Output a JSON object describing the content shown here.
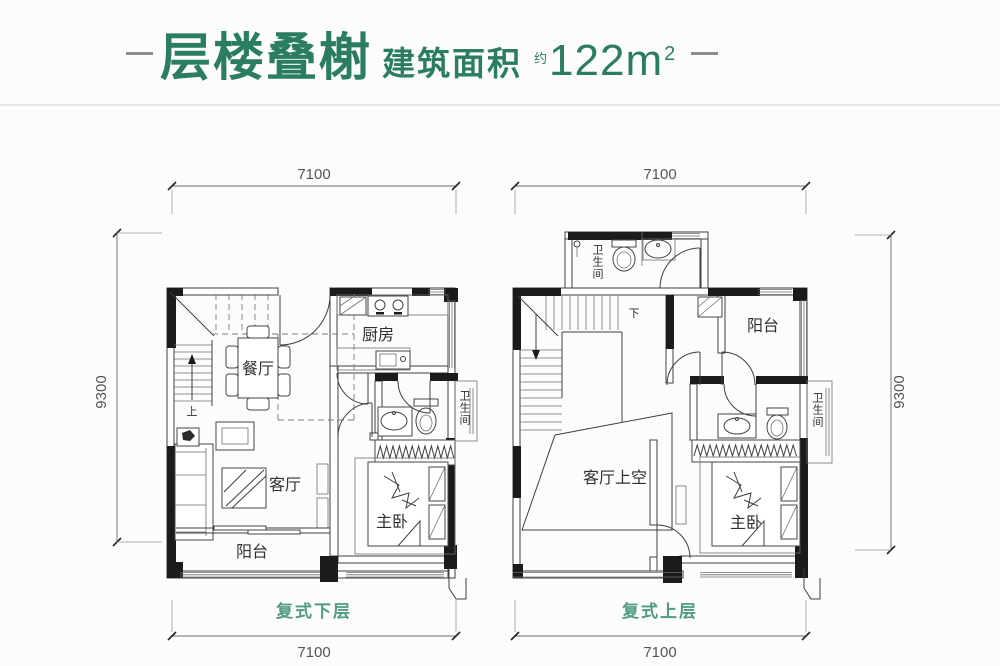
{
  "title": {
    "name": "层楼叠榭",
    "area_label": "建筑面积",
    "approx": "约",
    "area_value": "122m",
    "area_exponent": "2"
  },
  "plans": {
    "lower": {
      "caption": "复式下层",
      "dim_top": "7100",
      "dim_bottom": "7100",
      "dim_side": "9300",
      "stair": "上",
      "rooms": {
        "dining": "餐厅",
        "kitchen": "厨房",
        "bath": "卫生间",
        "living": "客厅",
        "master": "主卧",
        "balcony": "阳台"
      }
    },
    "upper": {
      "caption": "复式上层",
      "dim_top": "7100",
      "dim_bottom": "7100",
      "dim_side": "9300",
      "stair": "下",
      "rooms": {
        "bath_top": "卫生间",
        "balcony": "阳台",
        "living_void": "客厅上空",
        "master": "主卧",
        "bath": "卫生间"
      }
    }
  },
  "colors": {
    "title_green": "#2b7d60",
    "caption_green": "#4f9c7e",
    "wall": "#1b1b1b",
    "line": "#3f3f3f",
    "dim": "#6a6a6a",
    "divider_gray": "#e6e6e6",
    "dash_gray": "#8d8d8d"
  }
}
